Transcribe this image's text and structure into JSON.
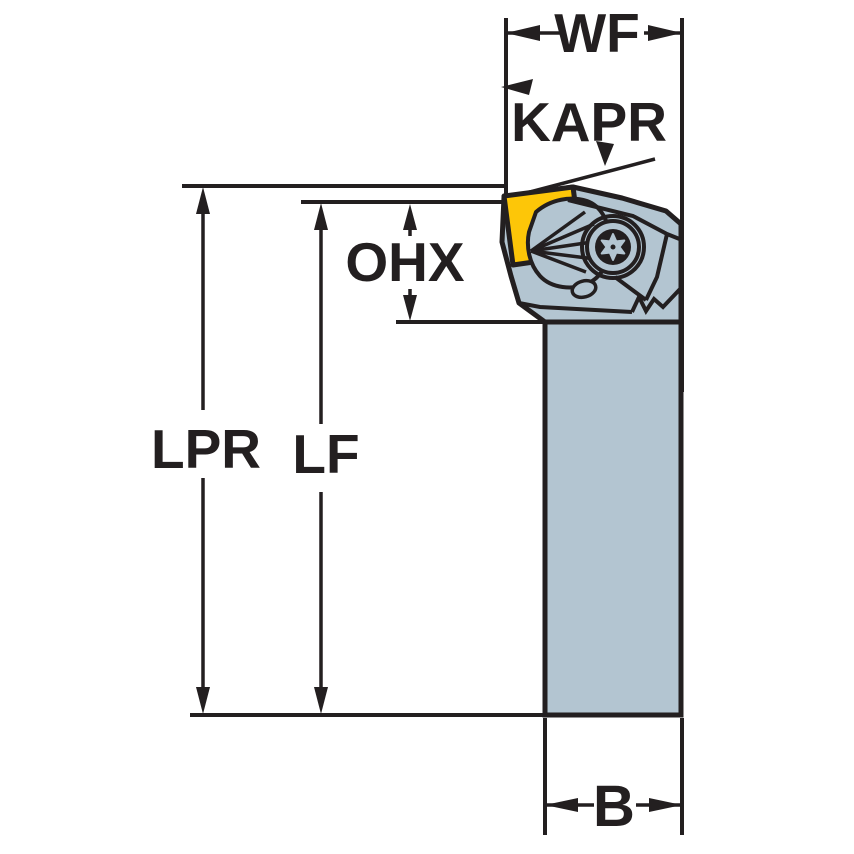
{
  "drawing": {
    "type": "technical dimension diagram",
    "subject": "turning tool holder with clamped insert, side view",
    "dimension_labels": {
      "wf": "WF",
      "kapr": "KAPR",
      "ohx": "OHX",
      "lpr": "LPR",
      "lf": "LF",
      "b": "B"
    },
    "colors": {
      "outline": "#231f20",
      "body": "#b3c5d1",
      "insert": "#fdc608",
      "background": "#ffffff"
    }
  }
}
